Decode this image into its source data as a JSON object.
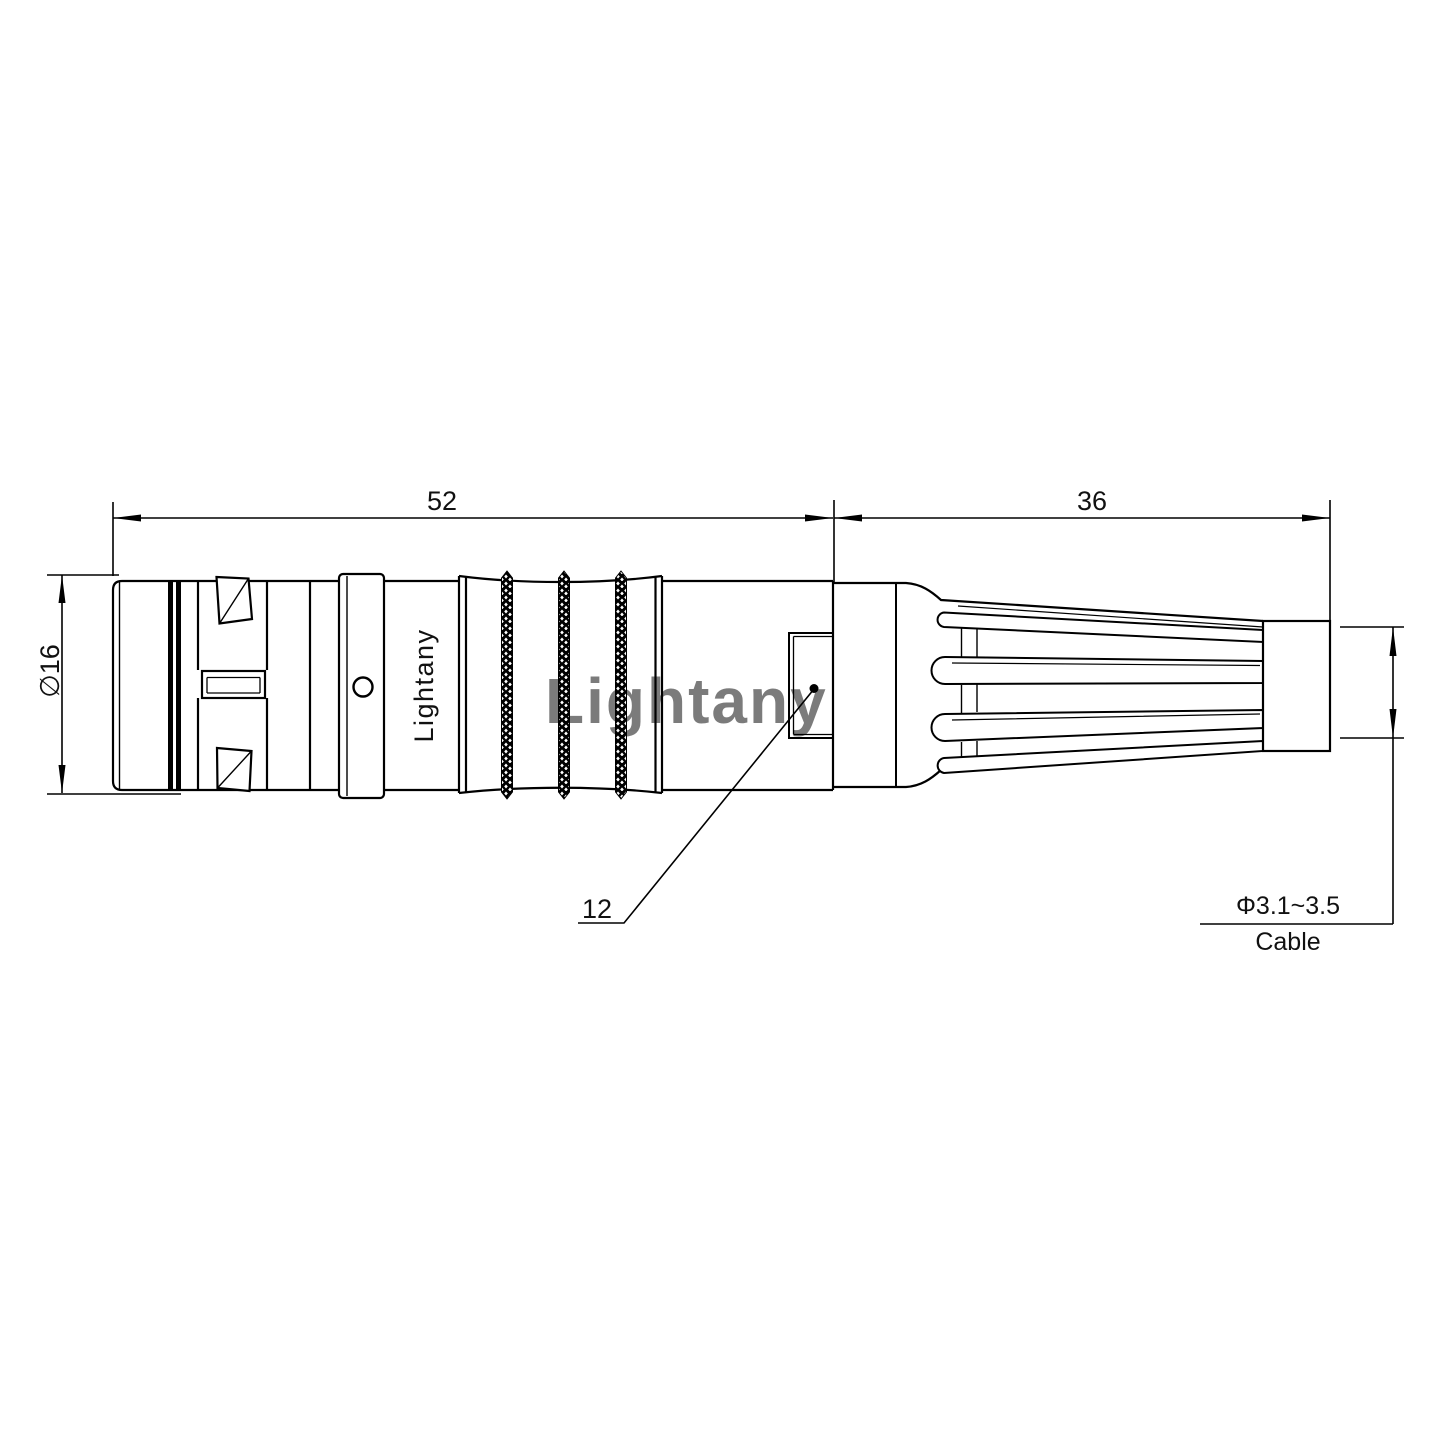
{
  "labels": {
    "front_length": "52",
    "rear_length": "36",
    "outer_diameter": "∅16",
    "window_ref": "12",
    "cable_diameter": "Φ3.1~3.5",
    "cable": "Cable"
  },
  "branding": {
    "body_text": "Lightany",
    "watermark": "Lightany"
  },
  "colors": {
    "line": "#000000",
    "watermark": "#ee8f96"
  }
}
